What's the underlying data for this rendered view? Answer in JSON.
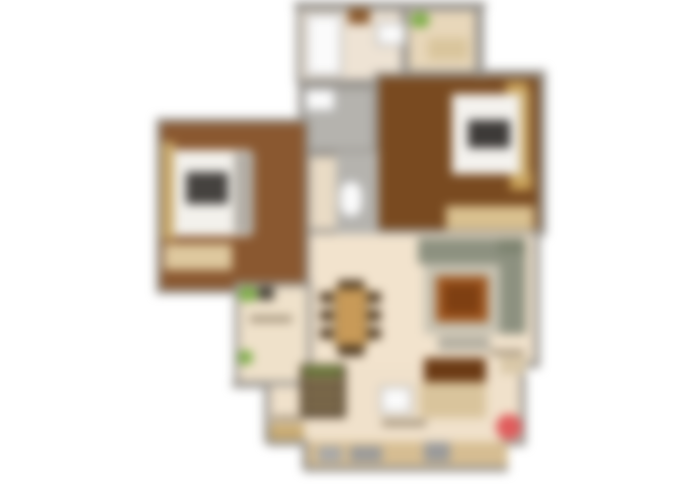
{
  "canvas": {
    "width": 700,
    "height": 488,
    "background": "#ffffff",
    "blur_px": 5
  },
  "palette": {
    "wall": "#98948e",
    "floor_beige": "#f2e3cd",
    "floor_balcony": "#e8d7ba",
    "floor_wood_dark": "#794a20",
    "floor_wood_mid": "#8a5830",
    "tile_gray": "#b5b3ae",
    "fixture_white": "#fbfbfb",
    "plant_green": "#7fae4a",
    "sofa_green_gray": "#8d9180",
    "rug_gray": "#c7c2b2",
    "coffee_table_brown": "#a0571f",
    "accent_red": "#e05c5c",
    "wardrobe_tan": "#d9c08f"
  },
  "floors": [
    {
      "name": "hall-corridor-floor",
      "rect": [
        304,
        190,
        76,
        44
      ],
      "color": "#f0e1cb"
    },
    {
      "name": "living-dining-floor",
      "rect": [
        298,
        232,
        240,
        136
      ],
      "color": "#f2e3cd"
    },
    {
      "name": "kitchen-floor",
      "rect": [
        298,
        366,
        228,
        76
      ],
      "color": "#f0e1cb"
    },
    {
      "name": "hall-left-floor",
      "rect": [
        266,
        386,
        60,
        58
      ],
      "color": "#f0e1cb"
    },
    {
      "name": "kitchen-protrusion-floor",
      "rect": [
        304,
        440,
        202,
        28
      ],
      "color": "#efddc0"
    }
  ],
  "rooms": [
    {
      "name": "top-bathroom",
      "rect": [
        296,
        6,
        110,
        78
      ],
      "color": "#eee3d4"
    },
    {
      "name": "top-balcony",
      "rect": [
        404,
        6,
        76,
        76
      ],
      "color": "#e8d7ba"
    },
    {
      "name": "bedroom-right",
      "rect": [
        374,
        72,
        170,
        162
      ],
      "color": "#794a20"
    },
    {
      "name": "bathroom-middle",
      "rect": [
        298,
        84,
        80,
        70
      ],
      "color": "#b5b3ae"
    },
    {
      "name": "toilet-middle",
      "rect": [
        298,
        152,
        80,
        82
      ],
      "color": "#e9dbc5"
    },
    {
      "name": "bedroom-left",
      "rect": [
        156,
        118,
        154,
        176
      ],
      "color": "#8a5830"
    },
    {
      "name": "study-balcony",
      "rect": [
        234,
        282,
        78,
        104
      ],
      "color": "#efe1ca"
    }
  ],
  "walls": [
    {
      "name": "wall-top",
      "rect": [
        294,
        2,
        192,
        6
      ]
    },
    {
      "name": "wall-balcony-right",
      "rect": [
        478,
        4,
        6,
        74
      ]
    },
    {
      "name": "wall-bedroom-right-top",
      "rect": [
        404,
        70,
        142,
        6
      ]
    },
    {
      "name": "wall-bedroom-right-side",
      "rect": [
        540,
        72,
        6,
        164
      ]
    },
    {
      "name": "wall-living-right",
      "rect": [
        534,
        232,
        6,
        134
      ]
    },
    {
      "name": "wall-right-step",
      "rect": [
        520,
        362,
        20,
        6
      ]
    },
    {
      "name": "wall-right-lower",
      "rect": [
        520,
        362,
        6,
        82
      ]
    },
    {
      "name": "wall-bottom-right",
      "rect": [
        500,
        440,
        26,
        6
      ]
    },
    {
      "name": "wall-protrusion-right",
      "rect": [
        502,
        442,
        6,
        28
      ]
    },
    {
      "name": "wall-protrusion-bottom",
      "rect": [
        304,
        466,
        204,
        6
      ]
    },
    {
      "name": "wall-protrusion-left",
      "rect": [
        302,
        442,
        6,
        28
      ]
    },
    {
      "name": "wall-step-left",
      "rect": [
        268,
        440,
        40,
        6
      ]
    },
    {
      "name": "wall-hall-left",
      "rect": [
        264,
        386,
        6,
        58
      ]
    },
    {
      "name": "wall-study-bottom",
      "rect": [
        232,
        382,
        38,
        6
      ]
    }
  ],
  "furniture": [
    {
      "name": "shower-stall",
      "rect": [
        306,
        14,
        36,
        62
      ],
      "color": "#fbfbfb",
      "border": "#a8a8a8"
    },
    {
      "name": "bath-shelf",
      "rect": [
        348,
        8,
        22,
        16
      ],
      "color": "#8a5a2e"
    },
    {
      "name": "washbasin-top",
      "rect": [
        376,
        22,
        30,
        24
      ],
      "color": "#fbfbfb",
      "border": "#a8a8a8"
    },
    {
      "name": "balcony-plant",
      "rect": [
        410,
        12,
        20,
        16
      ],
      "color": "#7fae4a",
      "radius": "50%"
    },
    {
      "name": "balcony-mat",
      "rect": [
        428,
        38,
        40,
        22
      ],
      "color": "#d9c59c"
    },
    {
      "name": "bathroom-sink",
      "rect": [
        304,
        88,
        32,
        24
      ],
      "color": "#fbfbfb",
      "border": "#a8a8a8"
    },
    {
      "name": "toilet-tile-strip",
      "rect": [
        336,
        152,
        42,
        82
      ],
      "color": "#b5b3ae"
    },
    {
      "name": "toilet-wc",
      "rect": [
        338,
        180,
        26,
        38
      ],
      "color": "#fbfbfb",
      "border": "#a8a8a8",
      "radius": "40%"
    },
    {
      "name": "bedroom-right-wardrobe",
      "rect": [
        446,
        206,
        88,
        24
      ],
      "color": "#d9c08f"
    },
    {
      "name": "bedroom-right-nightstand-top",
      "rect": [
        506,
        82,
        22,
        18
      ],
      "color": "#c9a158"
    },
    {
      "name": "bedroom-right-nightstand-bottom",
      "rect": [
        510,
        172,
        22,
        18
      ],
      "color": "#c9a158"
    },
    {
      "name": "bedroom-right-headboard",
      "rect": [
        516,
        90,
        14,
        90
      ],
      "color": "#c9a96a"
    },
    {
      "name": "bedroom-right-mattress",
      "rect": [
        452,
        94,
        68,
        80
      ],
      "color": "#f4f2ee"
    },
    {
      "name": "bedroom-right-pillows",
      "rect": [
        468,
        120,
        42,
        28
      ],
      "color": "#3d3a38"
    },
    {
      "name": "bedroom-left-headboard",
      "rect": [
        162,
        142,
        13,
        98
      ],
      "color": "#c9a96a"
    },
    {
      "name": "bedroom-left-mattress",
      "rect": [
        174,
        150,
        76,
        86
      ],
      "color": "#f3f1ec"
    },
    {
      "name": "bedroom-left-pillows",
      "rect": [
        186,
        172,
        42,
        32
      ],
      "color": "#45423f"
    },
    {
      "name": "bedroom-left-blanket",
      "rect": [
        234,
        152,
        20,
        82
      ],
      "color": "#b3aea6"
    },
    {
      "name": "bedroom-left-rug",
      "rect": [
        164,
        244,
        68,
        26
      ],
      "color": "#dec89e"
    },
    {
      "name": "study-plant-top",
      "rect": [
        238,
        286,
        20,
        16
      ],
      "color": "#7fae4a",
      "radius": "50%"
    },
    {
      "name": "study-dark-item",
      "rect": [
        258,
        287,
        16,
        13
      ],
      "color": "#4a4438"
    },
    {
      "name": "study-plant-bottom",
      "rect": [
        238,
        350,
        15,
        15
      ],
      "color": "#7fae4a",
      "radius": "50%"
    },
    {
      "name": "study-label-smudge",
      "rect": [
        250,
        316,
        42,
        6
      ],
      "color": "#9a8a72"
    },
    {
      "name": "dining-chair-left-1",
      "rect": [
        320,
        292,
        13,
        11
      ],
      "color": "#4f3a22"
    },
    {
      "name": "dining-chair-left-2",
      "rect": [
        320,
        310,
        13,
        11
      ],
      "color": "#4f3a22"
    },
    {
      "name": "dining-chair-left-3",
      "rect": [
        320,
        328,
        13,
        11
      ],
      "color": "#4f3a22"
    },
    {
      "name": "dining-chair-right-1",
      "rect": [
        368,
        292,
        13,
        11
      ],
      "color": "#4f3a22"
    },
    {
      "name": "dining-chair-right-2",
      "rect": [
        368,
        310,
        13,
        11
      ],
      "color": "#4f3a22"
    },
    {
      "name": "dining-chair-right-3",
      "rect": [
        368,
        328,
        13,
        11
      ],
      "color": "#4f3a22"
    },
    {
      "name": "dining-chair-top",
      "rect": [
        338,
        280,
        26,
        10
      ],
      "color": "#4f3a22"
    },
    {
      "name": "dining-chair-bottom",
      "rect": [
        338,
        346,
        26,
        10
      ],
      "color": "#4f3a22"
    },
    {
      "name": "dining-table",
      "rect": [
        334,
        288,
        34,
        58
      ],
      "color": "#c89a58",
      "border": "#8a6a3a"
    },
    {
      "name": "sofa-top-section",
      "rect": [
        418,
        238,
        88,
        26
      ],
      "color": "#8d9180"
    },
    {
      "name": "sofa-corner-section",
      "rect": [
        498,
        238,
        28,
        24
      ],
      "color": "#7e8471"
    },
    {
      "name": "sofa-right-section",
      "rect": [
        498,
        254,
        28,
        80
      ],
      "color": "#8d9180"
    },
    {
      "name": "living-rug",
      "rect": [
        424,
        264,
        76,
        70
      ],
      "color": "#c7c2b2"
    },
    {
      "name": "coffee-table",
      "rect": [
        436,
        276,
        52,
        46
      ],
      "color": "#a0571f"
    },
    {
      "name": "coffee-table-inner",
      "rect": [
        444,
        284,
        36,
        30
      ],
      "color": "#7e3f12"
    },
    {
      "name": "ottoman",
      "rect": [
        438,
        336,
        52,
        15
      ],
      "color": "#b5b0a2"
    },
    {
      "name": "side-table-right",
      "rect": [
        500,
        356,
        26,
        18
      ],
      "color": "#d9c8a8"
    },
    {
      "name": "side-table-label-smudge",
      "rect": [
        490,
        350,
        34,
        5
      ],
      "color": "#9a8a72"
    },
    {
      "name": "tv-unit",
      "rect": [
        424,
        358,
        62,
        24
      ],
      "color": "#6b3a14"
    },
    {
      "name": "kitchen-counter-right",
      "rect": [
        420,
        382,
        66,
        36
      ],
      "color": "#d9c49c"
    },
    {
      "name": "kitchen-island",
      "rect": [
        380,
        386,
        32,
        28
      ],
      "color": "#fbfbfb",
      "border": "#a8a8a8"
    },
    {
      "name": "kitchen-shelf-unit",
      "rect": [
        300,
        364,
        46,
        54
      ],
      "color": "#5f4e38"
    },
    {
      "name": "kitchen-shelf-top-items",
      "rect": [
        304,
        366,
        38,
        10
      ],
      "color": "#6f7f3f"
    },
    {
      "name": "kitchen-shelf-line-1",
      "rect": [
        304,
        380,
        38,
        4
      ],
      "color": "#a89468"
    },
    {
      "name": "kitchen-shelf-line-2",
      "rect": [
        304,
        392,
        38,
        4
      ],
      "color": "#a89468"
    },
    {
      "name": "kitchen-shelf-line-3",
      "rect": [
        304,
        404,
        38,
        4
      ],
      "color": "#a89468"
    },
    {
      "name": "kitchen-label-smudge",
      "rect": [
        382,
        420,
        44,
        6
      ],
      "color": "#9a8a72"
    },
    {
      "name": "hall-label-smudge",
      "rect": [
        272,
        416,
        32,
        5
      ],
      "color": "#9a8a72"
    },
    {
      "name": "shoe-rack",
      "rect": [
        270,
        424,
        34,
        16
      ],
      "color": "#c9ab72"
    },
    {
      "name": "bottom-counter",
      "rect": [
        308,
        442,
        200,
        24
      ],
      "color": "#d6bd92"
    },
    {
      "name": "counter-sink",
      "rect": [
        318,
        446,
        24,
        16
      ],
      "color": "#a8a8a8"
    },
    {
      "name": "counter-stove",
      "rect": [
        350,
        446,
        32,
        16
      ],
      "color": "#9a9a9a"
    },
    {
      "name": "counter-appliance",
      "rect": [
        424,
        442,
        26,
        20
      ],
      "color": "#9a9a9a"
    },
    {
      "name": "red-stool",
      "rect": [
        496,
        414,
        26,
        26
      ],
      "color": "#e05c5c",
      "radius": "50%"
    }
  ]
}
